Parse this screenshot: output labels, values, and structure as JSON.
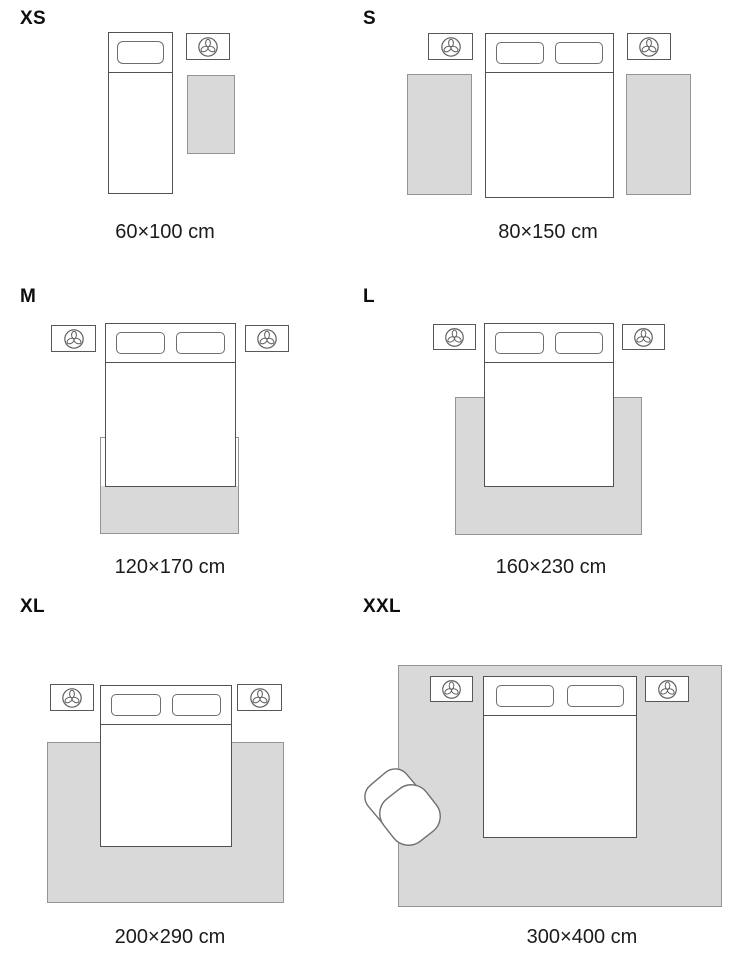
{
  "sizes": [
    {
      "id": "xs",
      "label": "XS",
      "dimensions": "60×100 cm"
    },
    {
      "id": "s",
      "label": "S",
      "dimensions": "80×150 cm"
    },
    {
      "id": "m",
      "label": "M",
      "dimensions": "120×170 cm"
    },
    {
      "id": "l",
      "label": "L",
      "dimensions": "160×230 cm"
    },
    {
      "id": "xl",
      "label": "XL",
      "dimensions": "200×290 cm"
    },
    {
      "id": "xxl",
      "label": "XXL",
      "dimensions": "300×400 cm"
    }
  ],
  "icons": {
    "nightstand": "plant-icon",
    "seating": "armchair"
  },
  "colors": {
    "background": "#ffffff",
    "rug_fill": "#d9d9d9",
    "rug_border": "#949497",
    "furniture_border": "#515154",
    "pillow_border": "#6e6e71",
    "text": "#1b1b1d"
  }
}
